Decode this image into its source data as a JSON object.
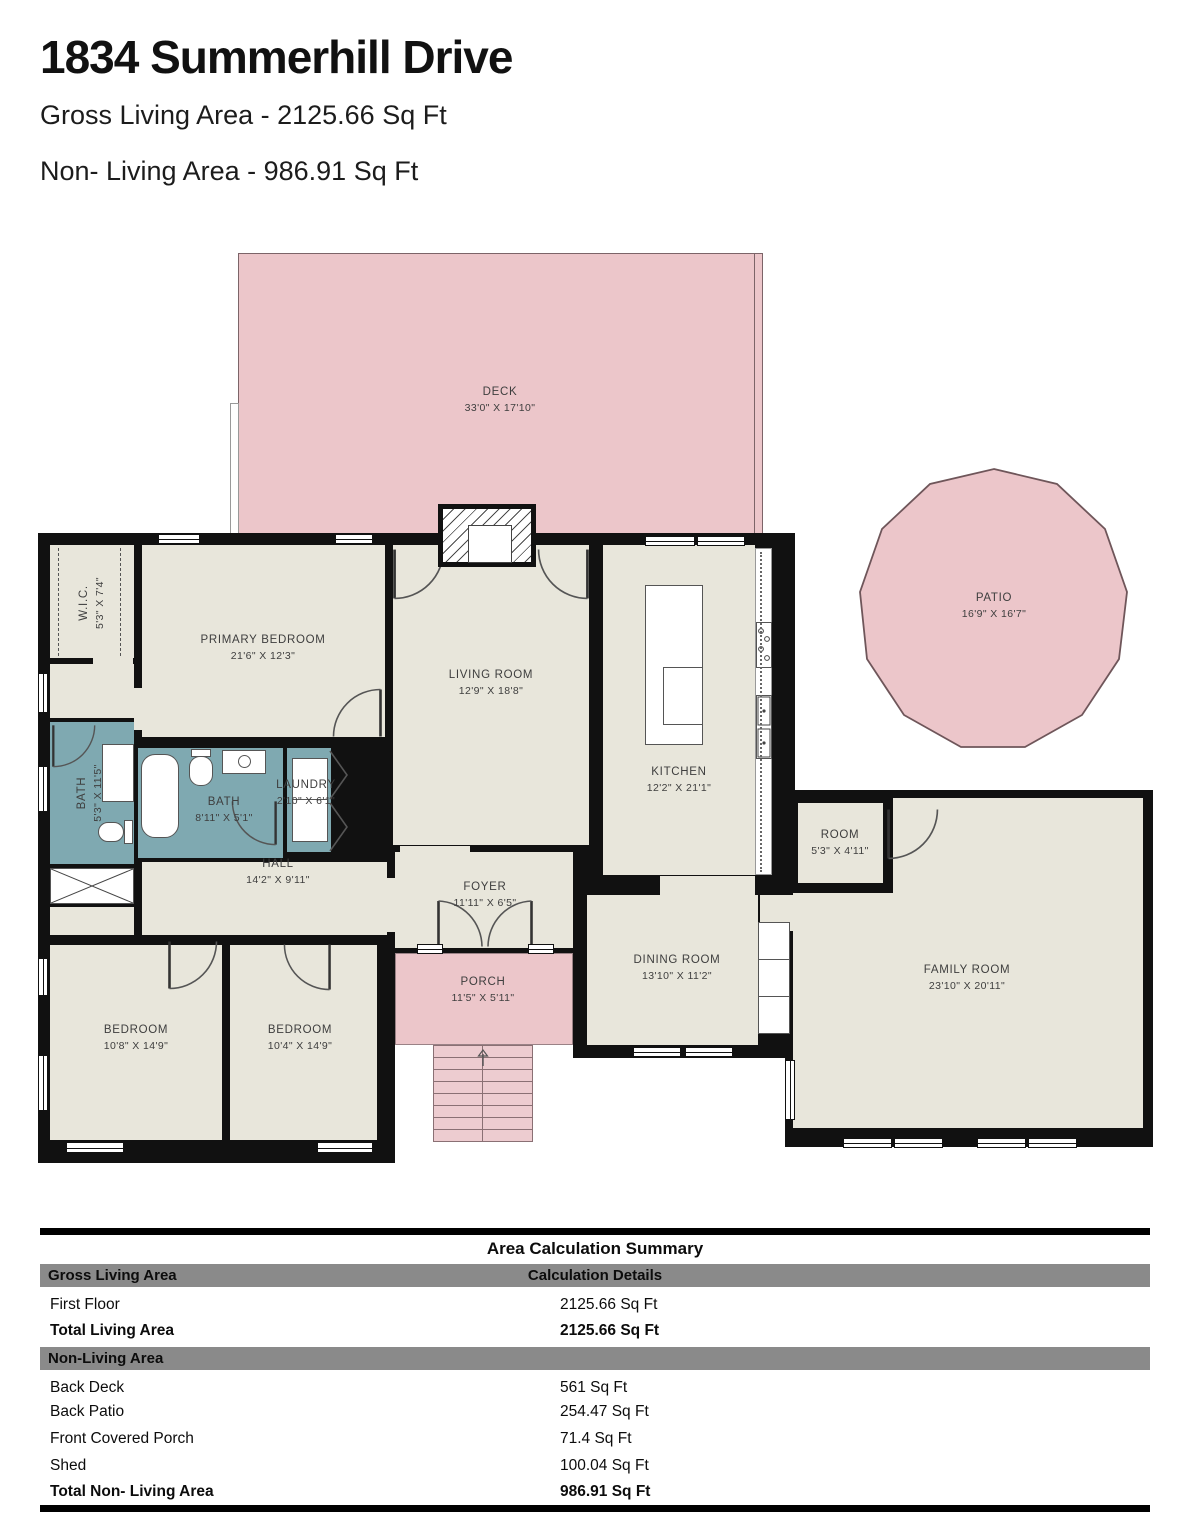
{
  "header": {
    "title": "1834 Summerhill Drive",
    "gross_living_area": "Gross Living Area - 2125.66 Sq Ft",
    "non_living_area": "Non- Living Area - 986.91 Sq Ft"
  },
  "colors": {
    "outdoor_pink": "#ecc6ca",
    "floor_beige": "#e8e6db",
    "bath_teal": "#7fa9b1",
    "wall_black": "#111111",
    "table_header_gray": "#8a8a8a"
  },
  "rooms": {
    "deck": {
      "name": "DECK",
      "dims": "33'0\" X 17'10\""
    },
    "patio": {
      "name": "PATIO",
      "dims": "16'9\" X 16'7\""
    },
    "wic": {
      "name": "W.I.C.",
      "dims": "5'3\" X 7'4\""
    },
    "primary_bedroom": {
      "name": "PRIMARY BEDROOM",
      "dims": "21'6\" X 12'3\""
    },
    "living_room": {
      "name": "LIVING ROOM",
      "dims": "12'9\" X 18'8\""
    },
    "kitchen": {
      "name": "KITCHEN",
      "dims": "12'2\" X 21'1\""
    },
    "bath_left": {
      "name": "BATH",
      "dims": "5'3\" X 11'5\""
    },
    "bath_mid": {
      "name": "BATH",
      "dims": "8'11\" X 5'1\""
    },
    "laundry": {
      "name": "LAUNDRY",
      "dims": "2'10\" X 6'1\""
    },
    "hall": {
      "name": "HALL",
      "dims": "14'2\" X 9'11\""
    },
    "foyer": {
      "name": "FOYER",
      "dims": "11'11\" X 6'5\""
    },
    "porch": {
      "name": "PORCH",
      "dims": "11'5\" X 5'11\""
    },
    "dining_room": {
      "name": "DINING ROOM",
      "dims": "13'10\" X 11'2\""
    },
    "room": {
      "name": "ROOM",
      "dims": "5'3\" X 4'11\""
    },
    "family_room": {
      "name": "FAMILY ROOM",
      "dims": "23'10\" X 20'11\""
    },
    "bedroom_left": {
      "name": "BEDROOM",
      "dims": "10'8\" X 14'9\""
    },
    "bedroom_mid": {
      "name": "BEDROOM",
      "dims": "10'4\" X 14'9\""
    }
  },
  "table": {
    "title": "Area Calculation Summary",
    "col1_header": "Gross Living Area",
    "col2_header": "Calculation Details",
    "living_rows": [
      {
        "label": "First Floor",
        "value": "2125.66 Sq Ft"
      },
      {
        "label": "Total Living Area",
        "value": "2125.66 Sq Ft"
      }
    ],
    "section2_header": "Non-Living Area",
    "nonliving_rows": [
      {
        "label": "Back Deck",
        "value": "561 Sq Ft"
      },
      {
        "label": "Back Patio",
        "value": "254.47 Sq Ft"
      },
      {
        "label": "Front Covered Porch",
        "value": "71.4 Sq Ft"
      },
      {
        "label": "Shed",
        "value": "100.04 Sq Ft"
      },
      {
        "label": "Total Non- Living Area",
        "value": "986.91 Sq Ft"
      }
    ]
  }
}
